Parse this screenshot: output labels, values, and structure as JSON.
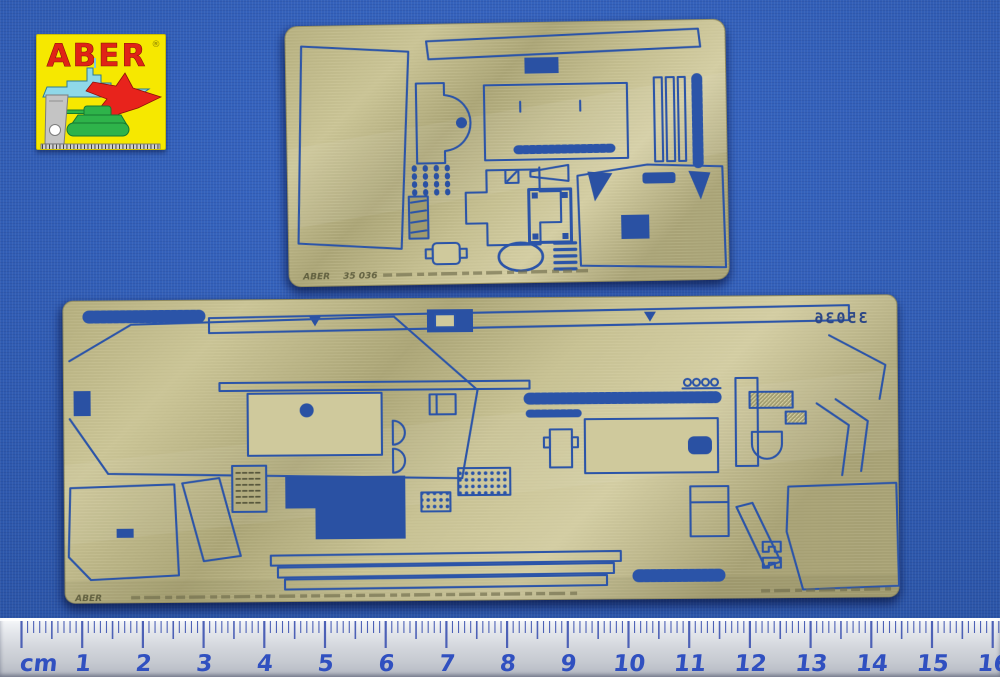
{
  "background": {
    "color": "#2e5ab1"
  },
  "logo": {
    "brand": "ABER",
    "registered_mark": "®",
    "background_color": "#f6e800",
    "brand_color": "#e02317",
    "ship_color": "#8fd8e8",
    "jet_color": "#e8231c",
    "tank_color": "#2eb34a",
    "square_color": "#c4c4c4"
  },
  "top_fret": {
    "material_color": "#b9b383",
    "etch_color": "#2b54a8",
    "caption_brand": "ABER",
    "caption_code": "35 036"
  },
  "bottom_fret": {
    "material_color": "#b9b383",
    "etch_color": "#2b54a8",
    "caption_brand": "ABER",
    "etched_number": "35036"
  },
  "ruler": {
    "unit_label": "cm",
    "numbers": [
      "1",
      "2",
      "3",
      "4",
      "5",
      "6",
      "7",
      "8",
      "9",
      "10",
      "11",
      "12",
      "13",
      "14",
      "15",
      "16"
    ],
    "number_color": "#3050c0",
    "tick_color": "#4d61b6"
  }
}
